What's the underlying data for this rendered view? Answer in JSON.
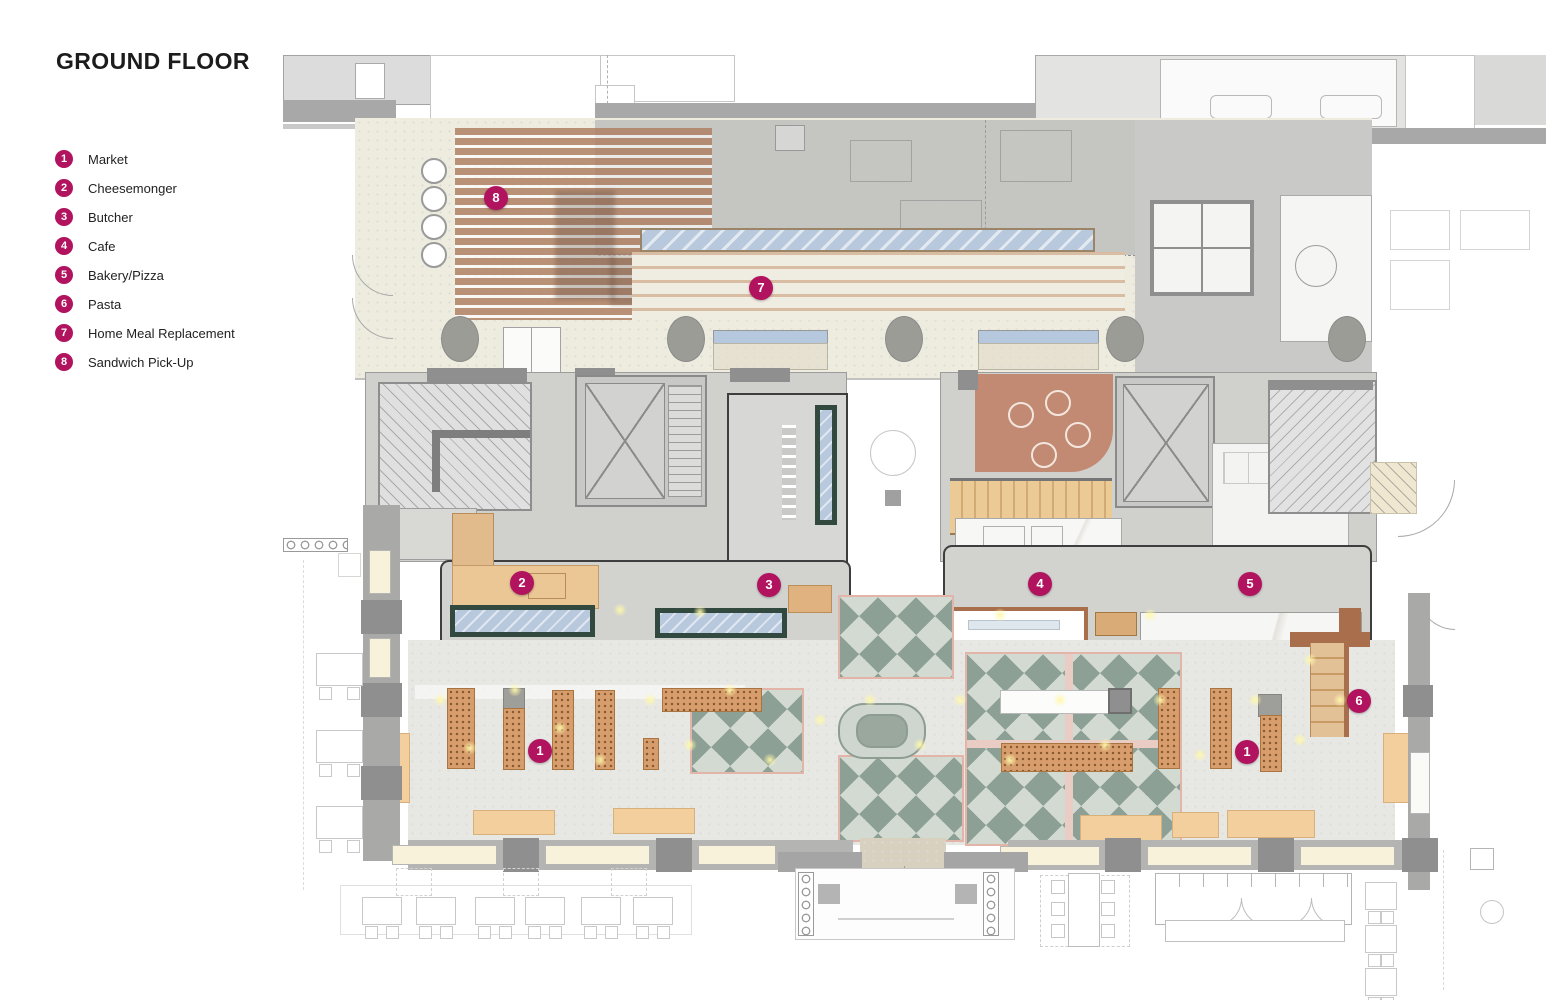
{
  "title": "GROUND FLOOR",
  "legend": {
    "items": [
      {
        "num": "1",
        "label": "Market"
      },
      {
        "num": "2",
        "label": "Cheesemonger"
      },
      {
        "num": "3",
        "label": "Butcher"
      },
      {
        "num": "4",
        "label": "Cafe"
      },
      {
        "num": "5",
        "label": "Bakery/Pizza"
      },
      {
        "num": "6",
        "label": "Pasta"
      },
      {
        "num": "7",
        "label": "Home Meal Replacement"
      },
      {
        "num": "8",
        "label": "Sandwich Pick-Up"
      }
    ]
  },
  "plan": {
    "markers": [
      {
        "num": "8",
        "area": "sandwich-pickup"
      },
      {
        "num": "7",
        "area": "home-meal-replacement"
      },
      {
        "num": "2",
        "area": "cheesemonger"
      },
      {
        "num": "3",
        "area": "butcher"
      },
      {
        "num": "4",
        "area": "cafe"
      },
      {
        "num": "5",
        "area": "bakery-pizza"
      },
      {
        "num": "6",
        "area": "pasta"
      },
      {
        "num": "1",
        "area": "market-west"
      },
      {
        "num": "1",
        "area": "market-east"
      }
    ]
  },
  "colors": {
    "accent": "#b1135f",
    "wall": "#a8a8a8",
    "wood": "#d79d6c",
    "tile": "#8da095",
    "glass": "#b9c9dd"
  }
}
